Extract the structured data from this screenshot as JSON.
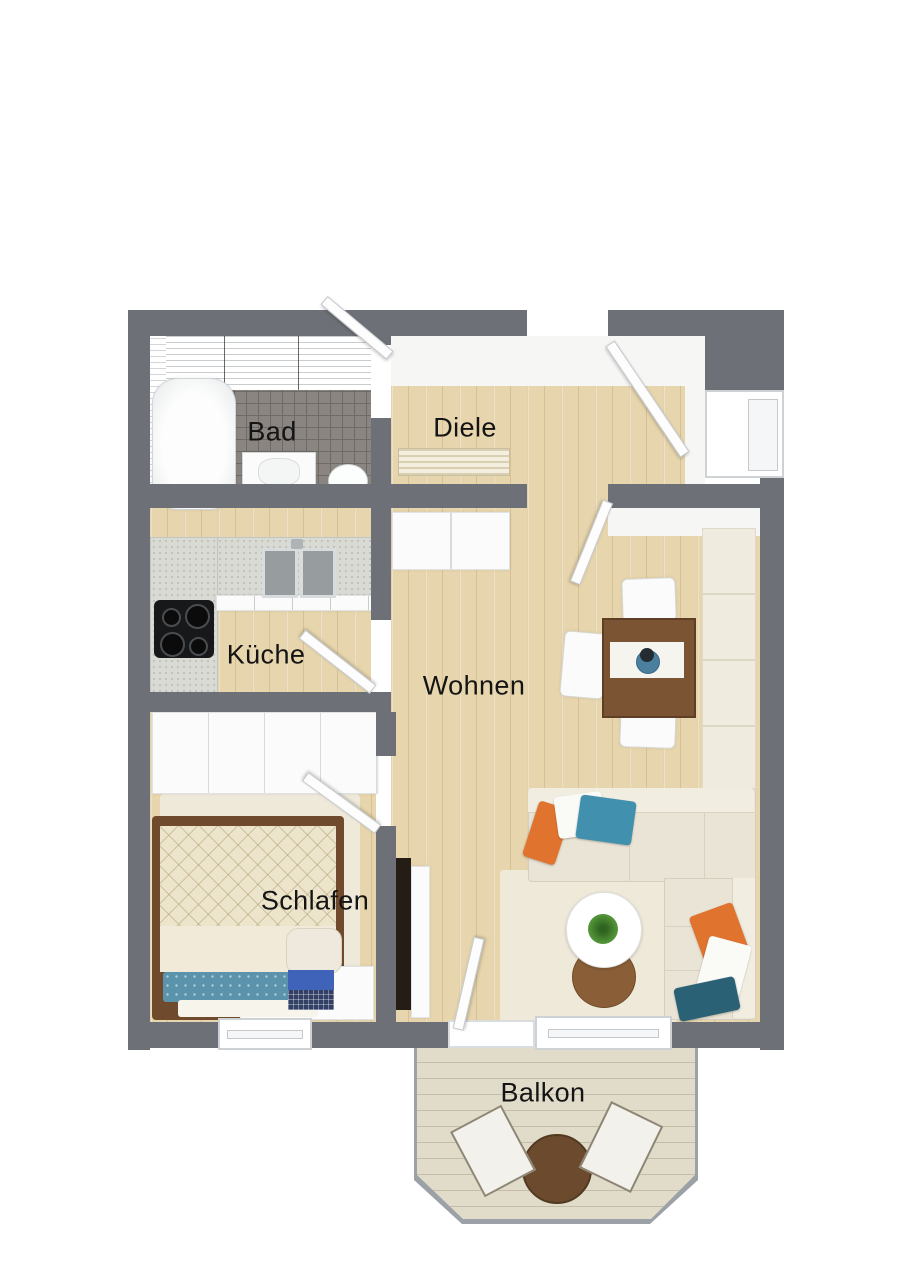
{
  "floor_plan": {
    "rooms": [
      {
        "id": "bad",
        "label": "Bad",
        "furniture": [
          "bathtub",
          "washbasin",
          "toilet"
        ]
      },
      {
        "id": "diele",
        "label": "Diele",
        "furniture": [
          "doormat",
          "entry-door"
        ]
      },
      {
        "id": "kueche",
        "label": "Küche",
        "furniture": [
          "l-shaped-counter",
          "double-sink",
          "cooktop"
        ]
      },
      {
        "id": "wohnen",
        "label": "Wohnen",
        "furniture": [
          "dining-table",
          "three-chairs",
          "sideboard",
          "wall-bench",
          "corner-sofa",
          "coffee-table",
          "side-table",
          "tv-panel",
          "rug"
        ]
      },
      {
        "id": "schlafen",
        "label": "Schlafen",
        "furniture": [
          "wardrobe",
          "single-bed",
          "desk",
          "laptop",
          "chair",
          "rug"
        ]
      },
      {
        "id": "balkon",
        "label": "Balkon",
        "furniture": [
          "bistro-table",
          "two-folding-chairs"
        ]
      }
    ],
    "colors": {
      "wall": "#6d7177",
      "wood_floor": "#e7d5ad",
      "bath_tile_floor": "#8a8580",
      "counter": "#d9dad4",
      "sofa": "#e9e4d5",
      "dining_table": "#7b5433",
      "pillow_orange": "#e0742f",
      "pillow_blue": "#4190ad",
      "pillow_teal": "#2b6175",
      "balcony_floor": "#e1dbc9"
    }
  }
}
